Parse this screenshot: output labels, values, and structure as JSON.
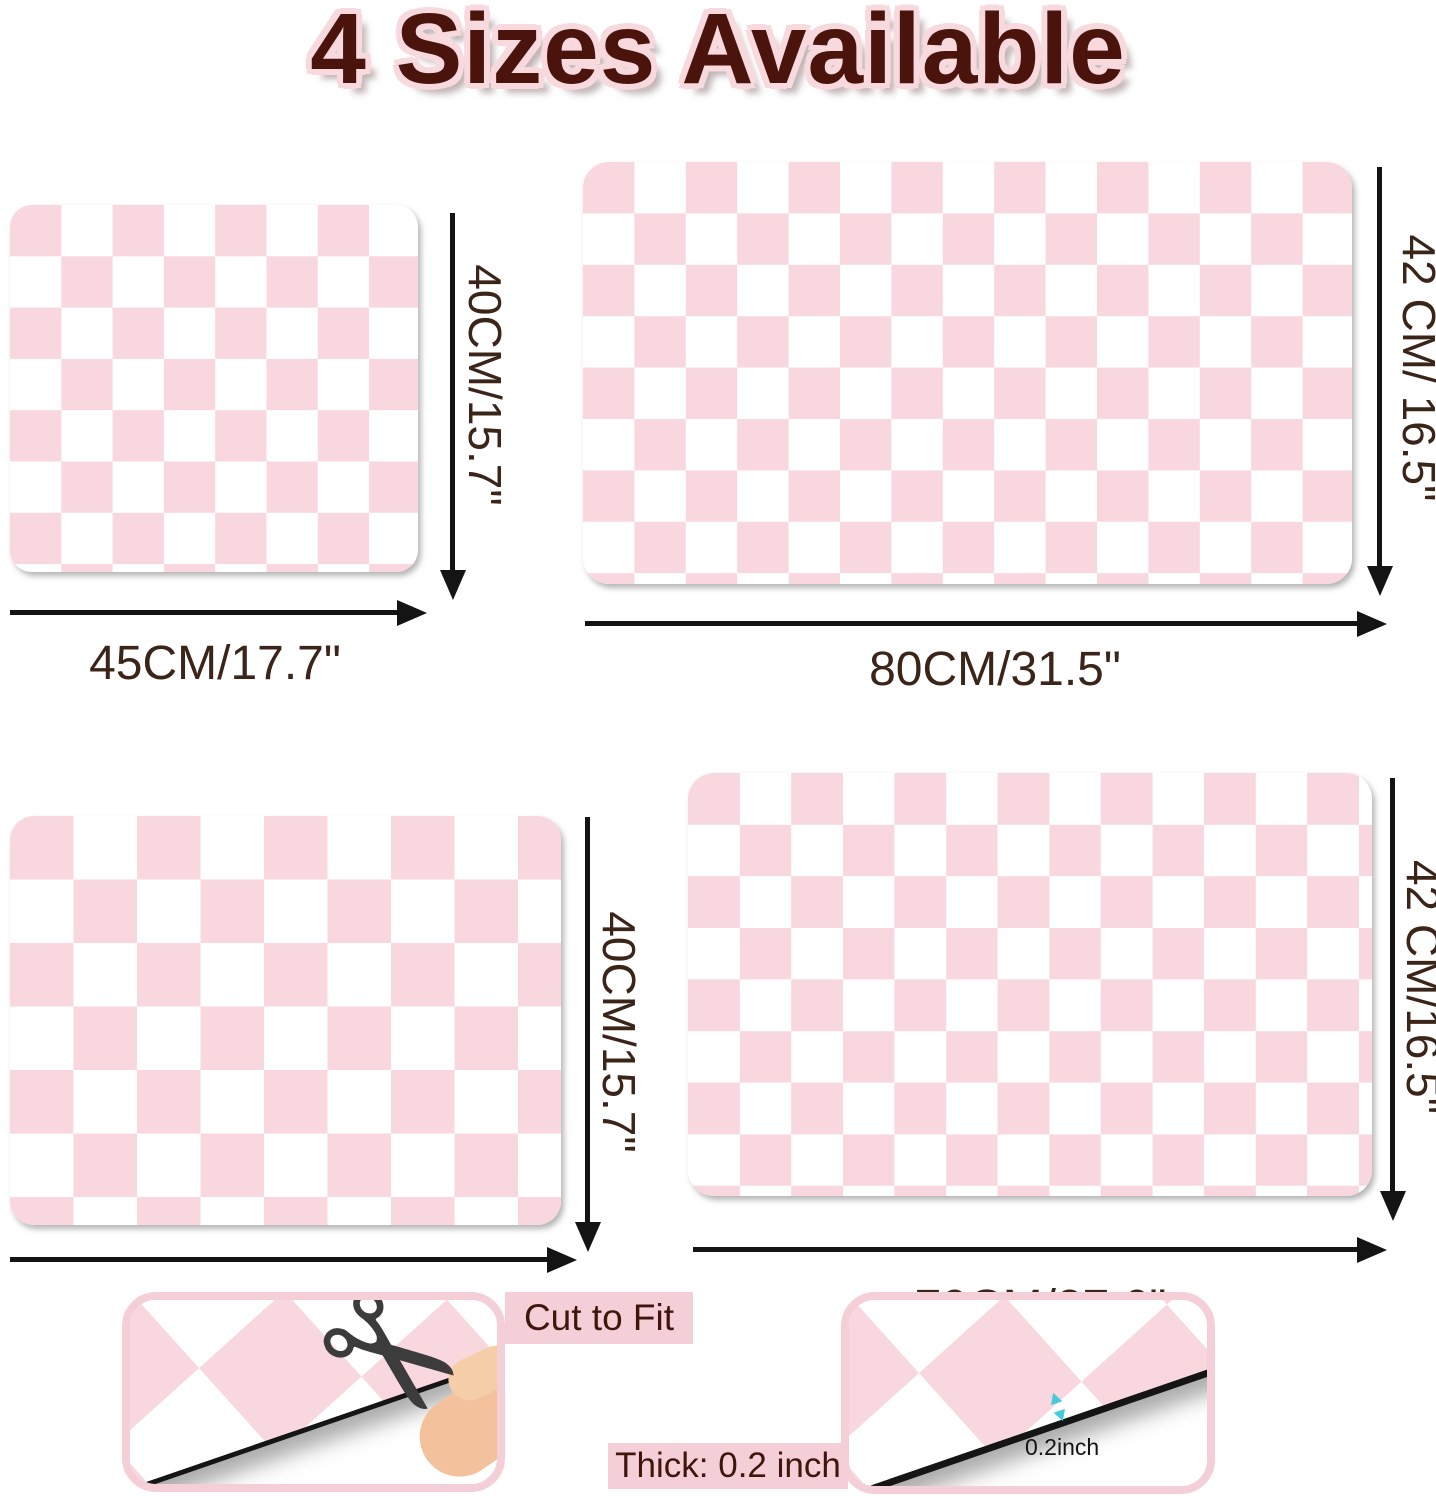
{
  "title": "4 Sizes Available",
  "mats": [
    {
      "name": "mat-45x40",
      "width_label": "45CM/17.7\"",
      "height_label": "40CM/15.7\""
    },
    {
      "name": "mat-80x42",
      "width_label": "80CM/31.5\"",
      "height_label": "42 CM/ 16.5\""
    },
    {
      "name": "mat-60x40",
      "width_label": "60CM/23.6\"",
      "height_label": "40CM/15.7\""
    },
    {
      "name": "mat-70x42",
      "width_label": "70CM/27.6\"",
      "height_label": "42 CM/16.5\""
    }
  ],
  "badges": {
    "cut_to_fit": "Cut to Fit",
    "thickness": "Thick: 0.2 inch",
    "thickness_note": "0.2inch"
  },
  "colors": {
    "checker-pink": "#f8d7de",
    "frame-pink": "#f5cfd7",
    "title-maroon": "#4a130c",
    "title-halo": "#f8d9dd",
    "label-brown": "#3b2418",
    "arrow-black": "#141414",
    "cyan-accent": "#45cbd9"
  }
}
